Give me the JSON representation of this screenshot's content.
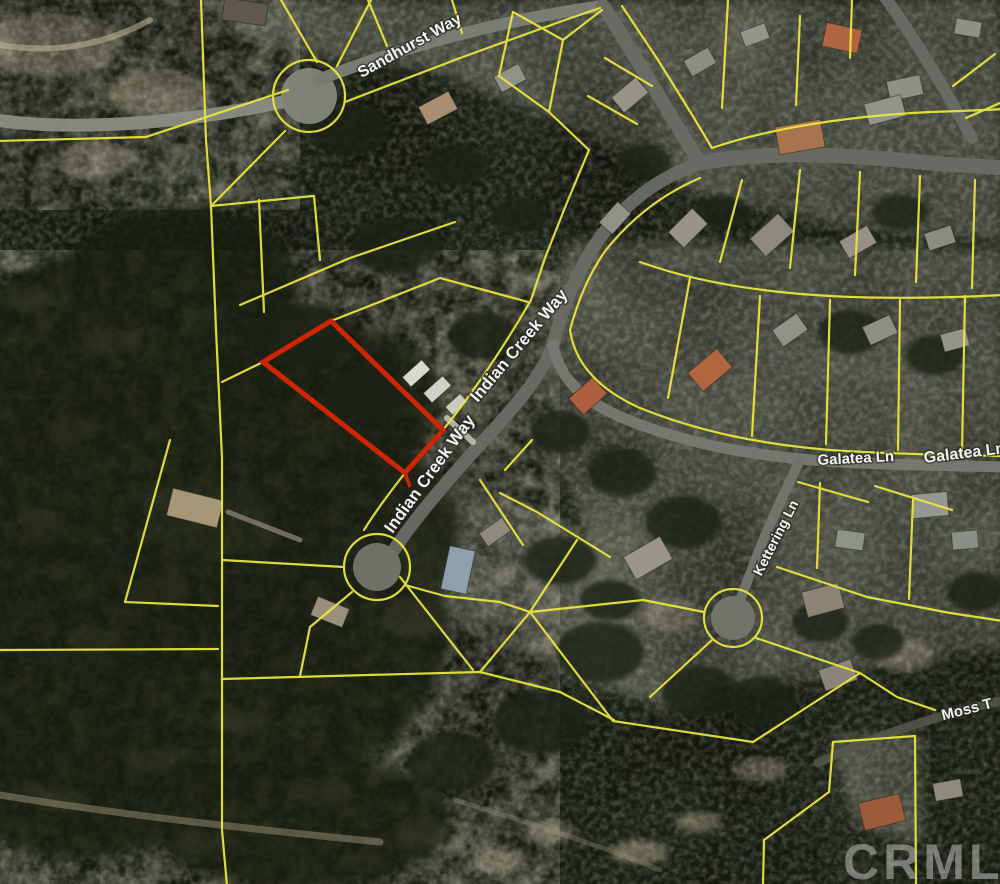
{
  "map": {
    "type": "aerial-parcel-map",
    "street_labels": {
      "sandhurst": "Sandhurst Way",
      "indian_creek_upper": "Indian Creek Way",
      "indian_creek_lower": "Indian Creek Way",
      "galatea_left": "Galatea Ln",
      "galatea_right": "Galatea Ln",
      "kettering": "Kettering Ln",
      "moss": "Moss T"
    },
    "watermark": "CRMLS",
    "subject_parcel_highlighted": true,
    "colors": {
      "parcel_line": "#e8e53e",
      "subject_outline": "#cf2505",
      "road": "#6a6d66",
      "label_text": "#f2f2f0",
      "watermark_text": "#c0c0c0"
    }
  }
}
